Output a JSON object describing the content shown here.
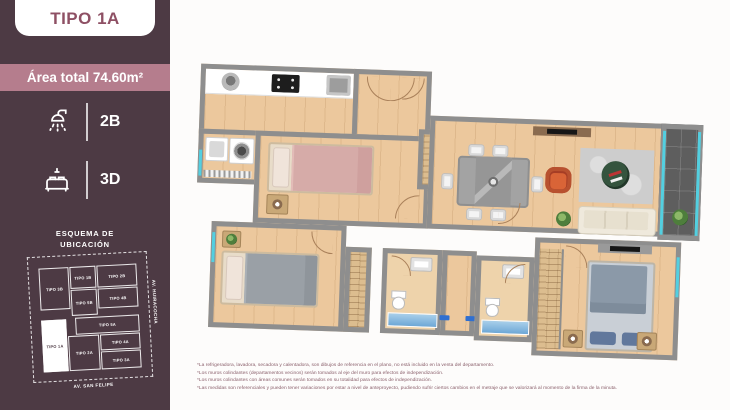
{
  "colors": {
    "sidebar_bg": "#4d3a44",
    "accent_band": "#b57d8d",
    "title_text": "#8e5064",
    "wall": "#8e8e8e",
    "floor_wood": "#ecc89d",
    "glass": "#53cfe0"
  },
  "sidebar": {
    "type_title": "TIPO 1A",
    "area_total": "Área total 74.60m²",
    "stats": [
      {
        "icon": "shower-icon",
        "value": "2B"
      },
      {
        "icon": "bed-icon",
        "value": "3D"
      }
    ],
    "schema_heading_line1": "ESQUEMA DE",
    "schema_heading_line2": "UBICACIÓN",
    "schema": {
      "street_bottom": "AV. SAN FELIPE",
      "street_right": "AV. HUIRACOCHA",
      "highlighted_unit": "TIPO 1A",
      "units": [
        {
          "label": "TIPO 3B"
        },
        {
          "label": "TIPO 1B"
        },
        {
          "label": "TIPO 2B"
        },
        {
          "label": "TIPO 4B"
        },
        {
          "label": "TIPO 5B"
        },
        {
          "label": "TIPO 5A"
        },
        {
          "label": "TIPO 4A"
        },
        {
          "label": "TIPO 2A"
        },
        {
          "label": "TIPO 3A"
        },
        {
          "label": "TIPO 1A"
        }
      ]
    }
  },
  "plan": {
    "footnotes": [
      "*La refrigeradora, lavadora, secadora y calentadora, son dibujos de referencia en el plano, no está incluido en la venta del departamento.",
      "*Los muros colindantes (departamentos vecinos) serán tomados al eje del muro para efectos de independización.",
      "*Los muros colindantes con áreas comunes serán tomados en su totalidad para efectos de independización.",
      "*Las medidas son referenciales y pueden tener variaciones por estar a nivel de anteproyecto, pudiendo sufrir ciertos cambios en el metraje que se valorizará al momento de la firma de la minuta."
    ]
  }
}
